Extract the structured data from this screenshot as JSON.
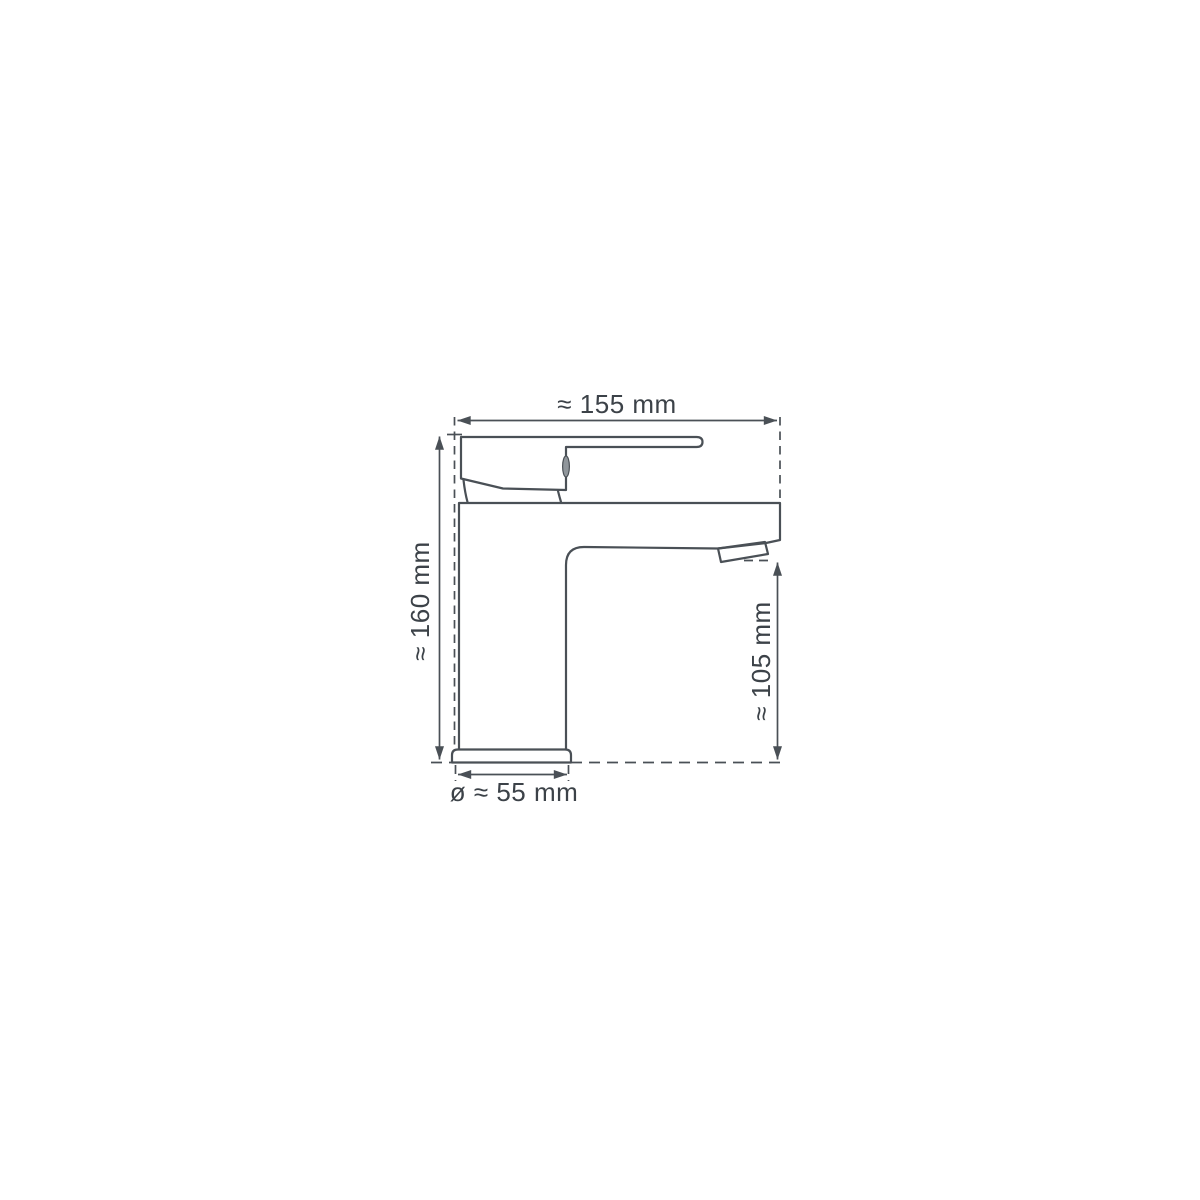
{
  "drawing": {
    "background_color": "#ffffff",
    "line_color": "#4a5056",
    "text_color": "#3c4248",
    "dimensions": {
      "overall_width": {
        "label": "≈ 155 mm",
        "value_mm": 155
      },
      "overall_height": {
        "label": "≈ 160 mm",
        "value_mm": 160
      },
      "spout_outlet_height": {
        "label": "≈ 105 mm",
        "value_mm": 105
      },
      "base_diameter": {
        "label": "ø ≈ 55 mm",
        "value_mm": 55
      }
    }
  }
}
